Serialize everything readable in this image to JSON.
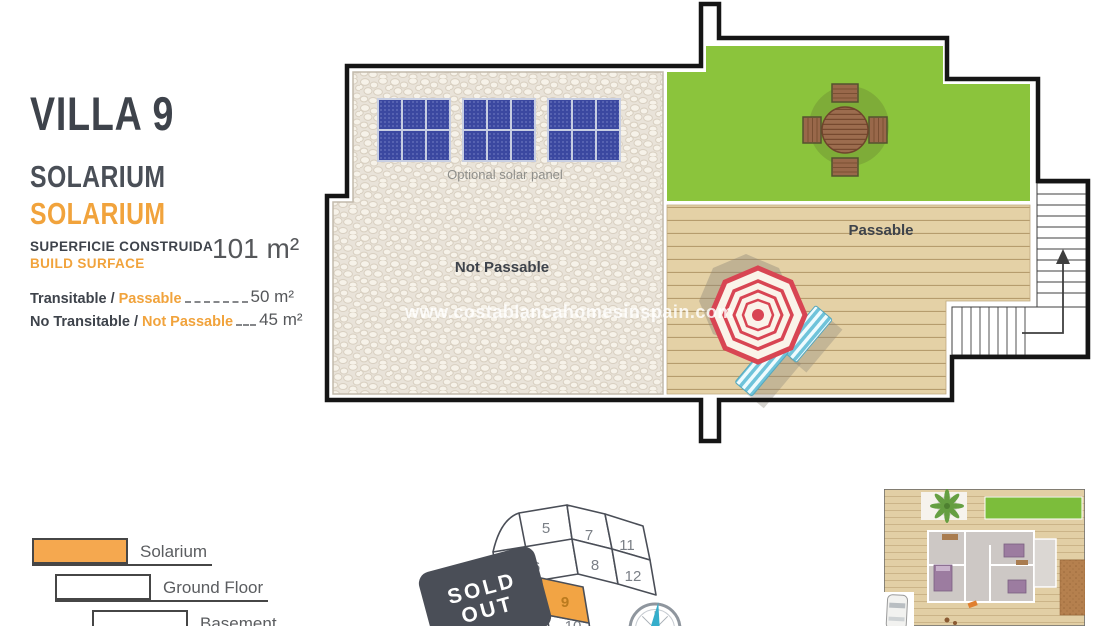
{
  "header": {
    "title": "VILLA 9",
    "floor_label": "SOLARIUM",
    "floor_label_accent": "SOLARIUM",
    "build_surface": {
      "label_primary": "SUPERFICIE CONSTRUIDA",
      "label_secondary": "BUILD SURFACE",
      "value": "101 m²"
    },
    "areas": [
      {
        "label": "Transitable /",
        "label_accent": "Passable",
        "value": "50 m²"
      },
      {
        "label": "No Transitable /",
        "label_accent": "Not Passable",
        "value": "45 m²"
      }
    ]
  },
  "plan": {
    "solar_caption": "Optional solar panel",
    "zone_labels": {
      "not_passable": "Not Passable",
      "passable": "Passable"
    },
    "watermark": "www.costablancahomesinspain.com"
  },
  "legend": [
    {
      "label": "Solarium",
      "color": "#F5A84F"
    },
    {
      "label": "Ground Floor",
      "color": "#FFFFFF"
    },
    {
      "label": "Basement",
      "color": "#FFFFFF"
    }
  ],
  "plot_map": {
    "plots": [
      "5",
      "6",
      "7",
      "8",
      "11",
      "12"
    ],
    "current_plot": "9",
    "next_plot": "10",
    "sold_out_line1": "SOLD",
    "sold_out_line2": "OUT"
  },
  "colors": {
    "accent_orange": "#F1A33C",
    "dark_text": "#3E434B",
    "grass_green": "#8BC43C",
    "deck_tan": "#E4D1A6",
    "gravel_beige": "#E9E3D9",
    "umbrella_red": "#D84553",
    "lounger_blue": "#6FC3DA",
    "solar_panel_blue": "#3B48A0",
    "sold_out_gray": "#4A4E57"
  }
}
